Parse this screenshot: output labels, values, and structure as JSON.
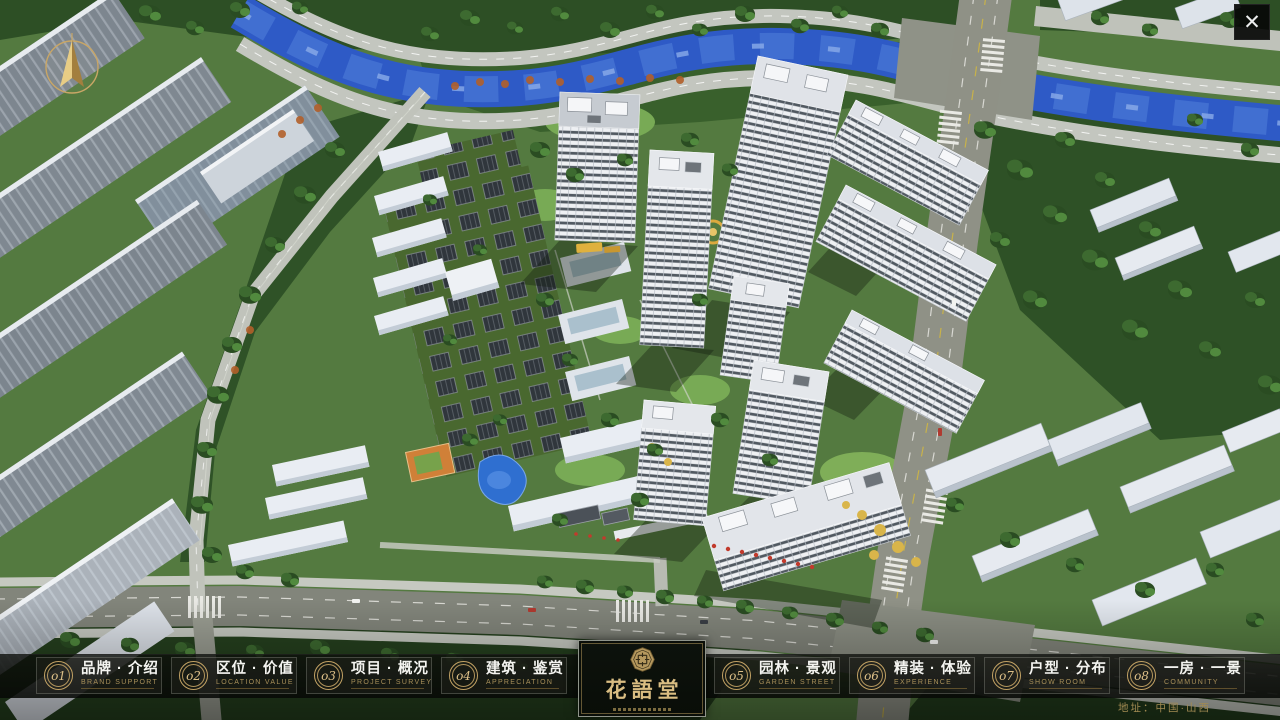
{
  "app": {
    "close_glyph": "✕"
  },
  "icons": {
    "compass": "compass-north-arrow",
    "close": "close-x",
    "seal": "octagonal-seal-emblem"
  },
  "colors": {
    "gold": "#c2a264",
    "bar_background": "#0b0d0a",
    "river_blue": "#2e5ac6"
  },
  "nav": {
    "items": [
      {
        "num": "o1",
        "zh": "品牌 · 介绍",
        "en": "BRAND SUPPORT"
      },
      {
        "num": "o2",
        "zh": "区位 · 价值",
        "en": "LOCATION VALUE"
      },
      {
        "num": "o3",
        "zh": "项目 · 概况",
        "en": "PROJECT SURVEY"
      },
      {
        "num": "o4",
        "zh": "建筑 · 鉴赏",
        "en": "APPRECIATION"
      },
      {
        "num": "o5",
        "zh": "园林 · 景观",
        "en": "GARDEN STREET"
      },
      {
        "num": "o6",
        "zh": "精装 · 体验",
        "en": "EXPERIENCE"
      },
      {
        "num": "o7",
        "zh": "户型 · 分布",
        "en": "SHOW ROOM"
      },
      {
        "num": "o8",
        "zh": "一房 · 一景",
        "en": "COMMUNITY"
      }
    ],
    "logo": {
      "name": "花語堂"
    },
    "address": "地址：中国·山西"
  }
}
